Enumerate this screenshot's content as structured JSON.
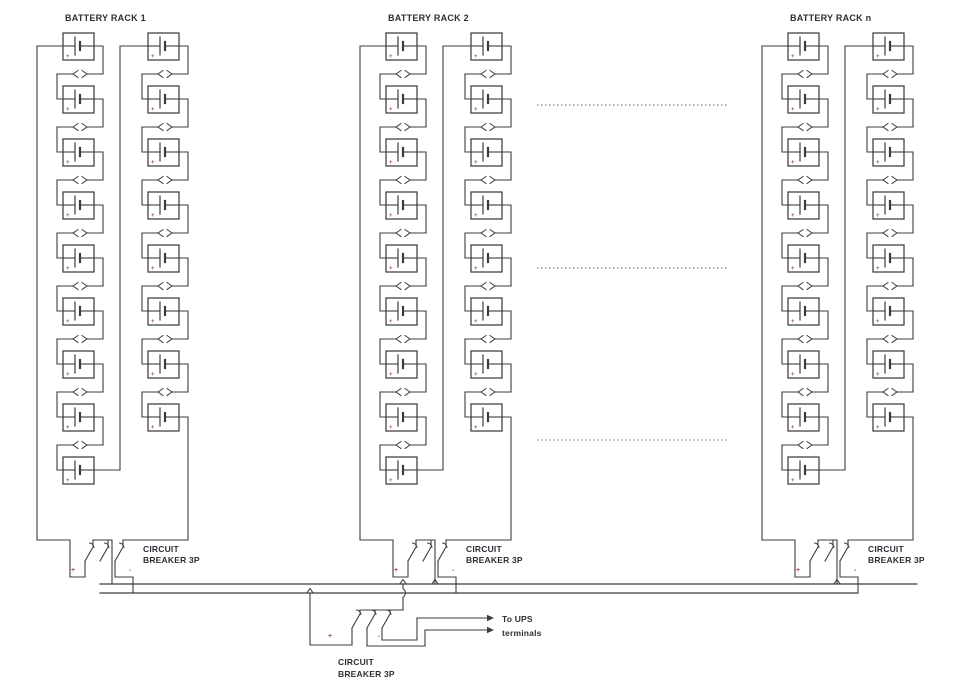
{
  "diagram": {
    "racks": [
      {
        "label": "BATTERY RACK 1",
        "x": 37
      },
      {
        "label": "BATTERY RACK 2",
        "x": 360
      },
      {
        "label": "BATTERY RACK n",
        "x": 762
      }
    ],
    "battery": {
      "left_column_count": 9,
      "right_column_count": 8,
      "plus_mark": "+"
    },
    "rack_breaker": {
      "label_line1": "CIRCUIT",
      "label_line2": "BREAKER 3P",
      "plus_mark": "+",
      "minus_mark": "-"
    },
    "main_breaker": {
      "label_line1": "CIRCUIT",
      "label_line2": "BREAKER 3P",
      "plus_mark": "+",
      "minus_mark": "-"
    },
    "output": {
      "label_line1": "To UPS",
      "label_line2": "terminals"
    },
    "colors": {
      "wire": "#3c3c3c",
      "text": "#2e2e36",
      "polarity": "#a05a48",
      "background": "#ffffff"
    }
  }
}
